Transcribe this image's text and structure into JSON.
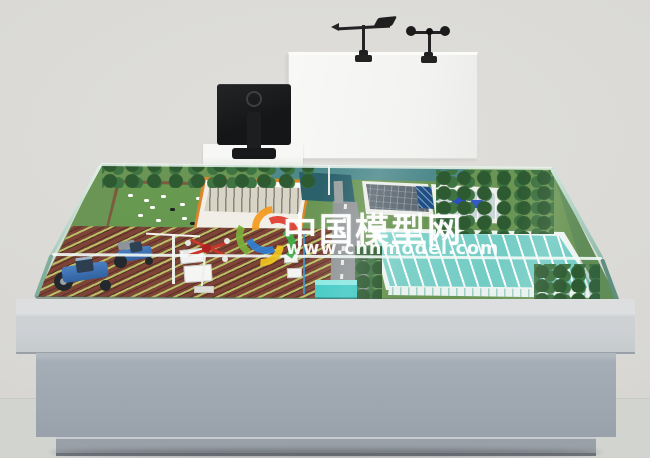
{
  "watermark": {
    "site_name": "中国模型网",
    "site_url": "www.chnmodel.com"
  },
  "colors": {
    "background_wall": "#dcdbd7",
    "floor": "#d3d5d1",
    "display_board": "#f6f7f4",
    "monitor_black": "#181a1b",
    "glass_tint": "#a8cfbf",
    "field_soil": "#7c4336",
    "crop_row_green": "#bac668",
    "pasture_green": "#67994f",
    "grass_green": "#6b9554",
    "greenhouse_roof_cyan": "#79d0c8",
    "road_gray": "#8e9294",
    "barn_trim_orange": "#e0862a",
    "tractor_blue": "#3a6fb5",
    "drone_red": "#c8372b",
    "pond_teal": "#2a616b",
    "nameplate_cyan": "#3fc9c3",
    "table_pedestal_gray": "#9fa7b1",
    "watermark_text": "#ffffff",
    "logo_blue": "#2e7fd4",
    "logo_orange": "#f59a1e",
    "logo_red": "#e03a2f",
    "logo_green": "#3fae49",
    "logo_yellow": "#f0c41f",
    "logo_lime": "#7ab03a"
  }
}
